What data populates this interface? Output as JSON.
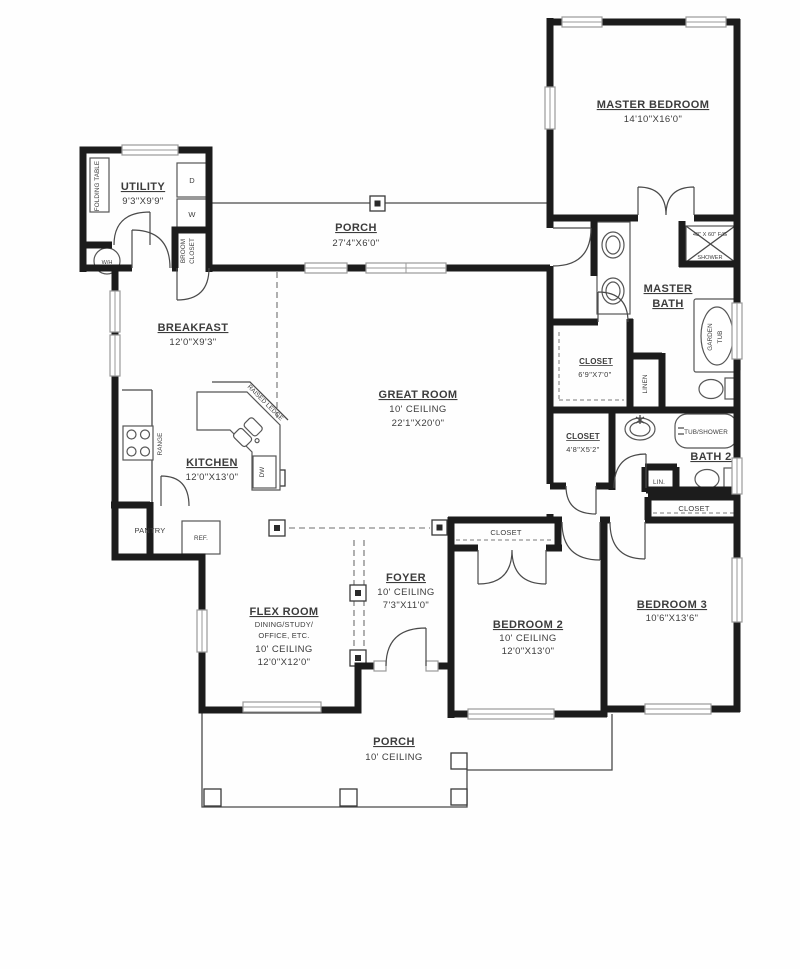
{
  "labels": {
    "utility": {
      "name": "UTILITY",
      "dims": "9'3\"X9'9\""
    },
    "folding_table": "FOLDING TABLE",
    "water_heater": "W/H",
    "dryer": "D",
    "washer": "W",
    "broom_closet": {
      "line1": "BROOM",
      "line2": "CLOSET"
    },
    "porch_rear": {
      "name": "PORCH",
      "dims": "27'4\"X6'0\""
    },
    "master_bedroom": {
      "name": "MASTER BEDROOM",
      "dims": "14'10\"X16'0\""
    },
    "shower": {
      "size": "48\" X 60\" F/G",
      "name": "SHOWER"
    },
    "master_bath": {
      "line1": "MASTER",
      "line2": "BATH"
    },
    "garden_tub": {
      "line1": "GARDEN",
      "line2": "TUB"
    },
    "master_closet": {
      "name": "CLOSET",
      "dims": "6'9\"X7'0\""
    },
    "linen": "LINEN",
    "breakfast": {
      "name": "BREAKFAST",
      "dims": "12'0\"X9'3\""
    },
    "great_room": {
      "name": "GREAT ROOM",
      "ceiling": "10' CEILING",
      "dims": "22'1\"X20'0\""
    },
    "kitchen": {
      "name": "KITCHEN",
      "dims": "12'0\"X13'0\""
    },
    "range": "RANGE",
    "raised_ledge": "RAISED LEDGE",
    "dishwasher": "DW",
    "refrigerator": "REF.",
    "pantry": "PANTRY",
    "closet_48": {
      "name": "CLOSET",
      "dims": "4'8\"X5'2\""
    },
    "tub_shower": "TUB/SHOWER",
    "bath2": "BATH 2",
    "lin": "LIN.",
    "hall_closet": "CLOSET",
    "bed2_closet": "CLOSET",
    "flex": {
      "name": "FLEX ROOM",
      "sub1": "DINING/STUDY/",
      "sub2": "OFFICE, ETC.",
      "ceiling": "10' CEILING",
      "dims": "12'0\"X12'0\""
    },
    "foyer": {
      "name": "FOYER",
      "ceiling": "10' CEILING",
      "dims": "7'3\"X11'0\""
    },
    "bedroom2": {
      "name": "BEDROOM 2",
      "ceiling": "10' CEILING",
      "dims": "12'0\"X13'0\""
    },
    "bedroom3": {
      "name": "BEDROOM 3",
      "dims": "10'6\"X13'6\""
    },
    "porch_front": {
      "name": "PORCH",
      "ceiling": "10' CEILING"
    }
  },
  "colors": {
    "wall": "#1c1c1c",
    "text": "#3c3c3c",
    "window": "#9a9a9a"
  }
}
